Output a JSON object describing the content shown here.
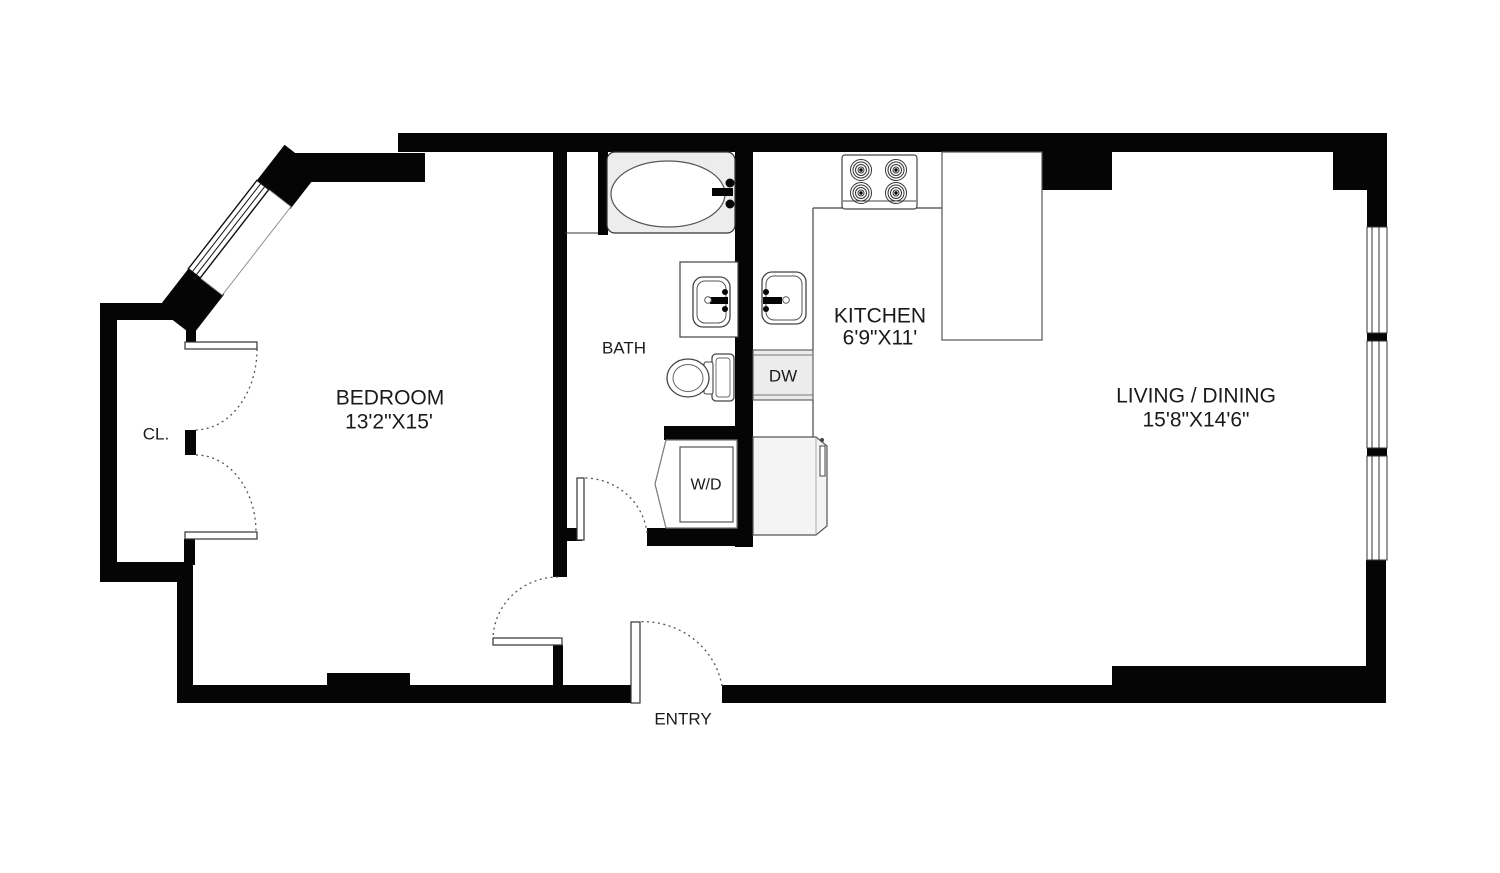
{
  "plan_title": "One-bedroom apartment floor plan",
  "rooms": {
    "bedroom": {
      "label": "BEDROOM",
      "dims": "13'2\"X15'"
    },
    "kitchen": {
      "label": "KITCHEN",
      "dims": "6'9\"X11'"
    },
    "living": {
      "label": "LIVING / DINING",
      "dims": "15'8\"X14'6\""
    },
    "bath": {
      "label": "BATH"
    },
    "closet": {
      "label": "CL."
    },
    "entry": {
      "label": "ENTRY"
    }
  },
  "appliances": {
    "washer_dryer": "W/D",
    "dishwasher": "DW"
  },
  "fixtures": [
    "bathtub",
    "bathroom-sink",
    "toilet",
    "kitchen-sink",
    "stove",
    "refrigerator",
    "counter",
    "washer-dryer",
    "dishwasher",
    "windows",
    "door-swings"
  ],
  "colors": {
    "wall": "#050505",
    "background": "#ffffff",
    "fixture_fill": "#ededed",
    "outline": "#444444"
  }
}
